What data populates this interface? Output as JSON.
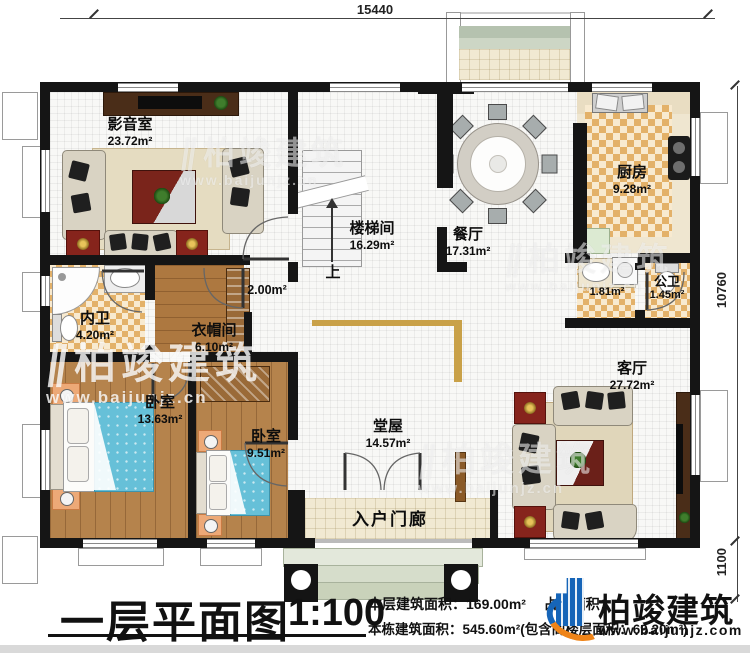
{
  "dimensions": {
    "top": "15440",
    "right": "10760",
    "front_steps": "1100"
  },
  "rooms": {
    "media": {
      "name": "影音室",
      "area": "23.72m²"
    },
    "stairwell": {
      "name": "楼梯间",
      "area": "16.29m²"
    },
    "dining": {
      "name": "餐厅",
      "area": "17.31m²"
    },
    "kitchen": {
      "name": "厨房",
      "area": "9.28m²"
    },
    "washstand": {
      "area": "1.81m²"
    },
    "public_wc": {
      "name": "公卫",
      "area": "1.45m²"
    },
    "hallway": {
      "area": "2.00m²"
    },
    "private_wc": {
      "name": "内卫",
      "area": "4.20m²"
    },
    "cloakroom": {
      "name": "衣帽间",
      "area": "6.10m²"
    },
    "bedroom1": {
      "name": "卧室",
      "area": "13.63m²"
    },
    "bedroom2": {
      "name": "卧室",
      "area": "9.51m²"
    },
    "main_hall": {
      "name": "堂屋",
      "area": "14.57m²"
    },
    "living": {
      "name": "客厅",
      "area": "27.72m²"
    },
    "entry_porch": {
      "name": "入户门廊"
    }
  },
  "stairs": {
    "up_label": "上"
  },
  "title_block": {
    "title": "一层平面图",
    "scale": "1:100",
    "floor_area_label": "本层建筑面积：",
    "floor_area_value": "169.00m²",
    "land_area_label": "占地面积：",
    "total_line": "本栋建筑面积：545.60m²(包含阁楼层面积：69.20m²)"
  },
  "brand": {
    "name": "柏竣建筑",
    "url": "www.baijunjz.com"
  },
  "watermark": {
    "name": "柏竣建筑",
    "url": "www.baijunjz.cn"
  },
  "colors": {
    "wall": "#151515",
    "checker_tile": "#e3b169",
    "wood_floor": "#ad7840",
    "bed_blue": "#66c0d8",
    "accent_red": "#86241c",
    "brand_blue": "#1665b8",
    "brand_orange": "#ef8418"
  }
}
